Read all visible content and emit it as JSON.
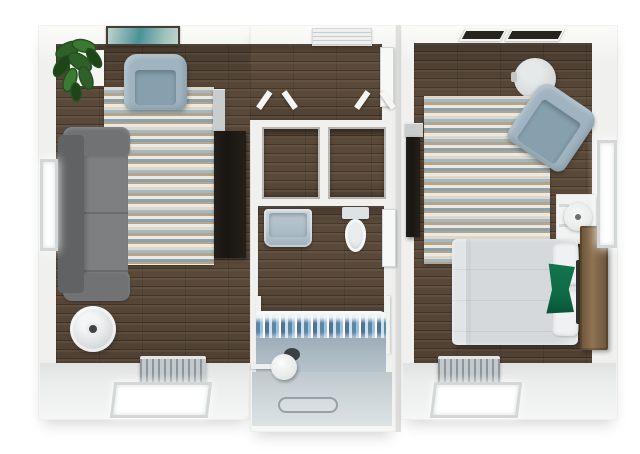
{
  "scene": {
    "kind": "3d-floor-plan-top-down-render",
    "units": [
      {
        "name": "living-room",
        "floor": "dark-wood-plank",
        "furniture": [
          "potted-plant",
          "plant-console",
          "wall-art",
          "armchair",
          "striped-area-rug",
          "sectional-sofa",
          "round-side-table",
          "media-shelf",
          "tv-console",
          "baseboard-radiator"
        ],
        "openings": [
          "left-wall-window",
          "bottom-wall-window"
        ]
      },
      {
        "name": "core-hall-closets-bathroom",
        "floor": "dark-wood-plank-and-tile",
        "furniture": [
          "ac-unit",
          "hall-door",
          "closet-left",
          "closet-right",
          "bifold-closet-doors",
          "vanity-sink",
          "toilet",
          "bathroom-door",
          "shower-curtain",
          "bathtub-ledge",
          "shower-floor",
          "shower-drain",
          "tub-drain-hole",
          "shower-seat",
          "grab-rails"
        ],
        "openings": [
          "open-passage-to-living-room"
        ]
      },
      {
        "name": "bedroom",
        "floor": "dark-wood-plank",
        "furniture": [
          "ceiling-vent-left",
          "ceiling-vent-right",
          "round-table",
          "armchair",
          "striped-area-rug",
          "wall-tv",
          "tv-shelf",
          "nightstand",
          "table-lamp",
          "bed",
          "white-pillows",
          "green-accent-pillow",
          "wood-headboard",
          "baseboard-radiator"
        ],
        "openings": [
          "right-wall-window",
          "bottom-wall-window"
        ]
      }
    ]
  },
  "colors": {
    "wall": "#f0f0ee",
    "seam": "#e0e0de",
    "floor_band": "#eaedec",
    "wood": "#5a4939",
    "rug_cream": "#ddd8cb",
    "rug_blue": "#a3b8c1",
    "rug_tan": "#b4a48b",
    "rug_white": "#ece9e0",
    "rug_slate": "#8ba1ac",
    "sofa_dark": "#606264",
    "sofa_arm": "#707274",
    "sofa_seat": "#7d7f81",
    "chair": "#9fb4c0",
    "chair_seat": "#87a0ae",
    "table_top": "#d9dcdd",
    "lamp": "#eceeee",
    "tv": "#191511",
    "shelf_gray": "#c9cdce",
    "bed": "#d6d9dc",
    "pillow": "#eff1f2",
    "green": "#0e6b45",
    "headboard": "#8f7354",
    "headboard_dark": "#6b5238",
    "sink": "#bccad3",
    "curtain_a": "#5b87a8",
    "curtain_b": "#9fc0d4",
    "curtain_c": "#4a7696",
    "curtain_white": "#f3f6f7",
    "tub": "#aab8c2",
    "shower": "#ccd4d8",
    "radiator": "#c3c9cc",
    "fin": "#8d969b",
    "frame": "#d3d7d8",
    "glow": "#ffffff",
    "art_frame": "#463d33",
    "art_teal": "#4b9198",
    "art_light": "#bfd3cd",
    "vent": "#26241f",
    "ac": "#eef0f0",
    "plant": "#2f6029",
    "plant_mid": "#3c7a33",
    "plant_dark": "#1d4519",
    "drain": "#97a1a7",
    "shadow_dark": "#3a4144"
  }
}
